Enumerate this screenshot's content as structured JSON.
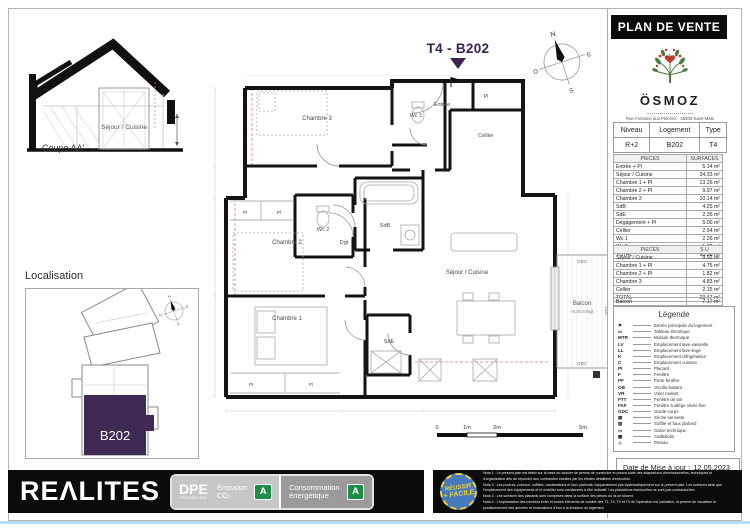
{
  "header": {
    "title": "PLAN DE VENTE"
  },
  "brand": {
    "name": "ÖSMOZ",
    "address": "Rue Fontaine aux Pèlerins - 35400 Saint-Malo"
  },
  "unit_banner": {
    "title": "T4 - B202"
  },
  "info_table": {
    "headers": [
      "Niveau",
      "Logement",
      "Type"
    ],
    "row": [
      "R+2",
      "B202",
      "T4"
    ]
  },
  "surfaces_table": {
    "headers": [
      "PIECES",
      "SURFACES"
    ],
    "rows": [
      [
        "Entrée + Pl",
        "5.14 m²"
      ],
      [
        "Séjour / Cuisine",
        "34.33 m²"
      ],
      [
        "Chambre 1 + Pl",
        "13.26 m²"
      ],
      [
        "Chambre 2 + Pl",
        "9.97 m²"
      ],
      [
        "Chambre 3",
        "10.14 m²"
      ],
      [
        "SdB",
        "4.25 m²"
      ],
      [
        "SdE",
        "2.35 m²"
      ],
      [
        "Dégagement + Pl",
        "5.00 m²"
      ],
      [
        "Cellier",
        "2.54 m²"
      ],
      [
        "Wc 1",
        "2.26 m²"
      ],
      [
        "Wc 2",
        "1.32 m²"
      ]
    ],
    "total_label": "TOTAL",
    "total_value": "90.56 m²"
  },
  "su_table": {
    "headers": [
      "PIECES",
      "S.U"
    ],
    "rows": [
      [
        "Séjour / Cuisine",
        "9.92 m²"
      ],
      [
        "Chambre 1 + Pl",
        "4.75 m²"
      ],
      [
        "Chambre 2 + Pl",
        "1.82 m²"
      ],
      [
        "Chambre 3",
        "4.83 m²"
      ],
      [
        "Cellier",
        "2.15 m²"
      ]
    ],
    "total_label": "TOTAL",
    "total_value": "23.47 m²",
    "balcon_label": "Balcon",
    "balcon_value": "7.17 m²"
  },
  "legend": {
    "title": "Légende",
    "items": [
      {
        "symbol": "⚑",
        "label": "Entrée principale du logement"
      },
      {
        "symbol": "▭",
        "label": "Tableau électrique"
      },
      {
        "symbol": "MTR",
        "label": "Module thermique"
      },
      {
        "symbol": "LV",
        "label": "Emplacement lave-vaisselle"
      },
      {
        "symbol": "LL",
        "label": "Emplacement lave-linge"
      },
      {
        "symbol": "K",
        "label": "Emplacement réfrigérateur"
      },
      {
        "symbol": "C",
        "label": "Emplacement cuisson"
      },
      {
        "symbol": "Pl",
        "label": "Placard"
      },
      {
        "symbol": "F",
        "label": "Fenêtre"
      },
      {
        "symbol": "PF",
        "label": "Porte fenêtre"
      },
      {
        "symbol": "OB",
        "label": "Oscillo-battant"
      },
      {
        "symbol": "VR",
        "label": "Volet roulant"
      },
      {
        "symbol": "FTT",
        "label": "Fenêtre de toit"
      },
      {
        "symbol": "FAF",
        "label": "Fenêtre à allège vitrée fixe"
      },
      {
        "symbol": "GDC",
        "label": "Garde-corps"
      },
      {
        "symbol": "▤",
        "label": "Sèche serviette"
      },
      {
        "symbol": "▨",
        "label": "Soffite et faux plafond"
      },
      {
        "symbol": "▭",
        "label": "Gaine technique"
      },
      {
        "symbol": "▦",
        "label": "Caillebotis"
      },
      {
        "symbol": "⊥",
        "label": "Poteau"
      }
    ]
  },
  "date_update": {
    "label": "Date de Mise à jour :",
    "value": "12.05.2023"
  },
  "coupe": {
    "caption": "Coupe AA'",
    "room_label": "Séjour / Cuisine"
  },
  "localisation": {
    "title": "Localisation",
    "unit": "B202"
  },
  "plan": {
    "rooms": {
      "chambre3": "Chambre 3",
      "wc1": "Wc 1",
      "entree": "Entrée",
      "cellier": "Cellier",
      "pl": "Pl",
      "wc2": "Wc 2",
      "sdb": "SdB",
      "dgt": "Dgt",
      "chambre2": "Chambre 2",
      "chambre1": "Chambre 1",
      "sde": "SdE",
      "sejour": "Séjour / Cuisine",
      "balcon": "Balcon"
    },
    "balcon_note": "+0.05 m/logt",
    "gdc": "GDC"
  },
  "scale_bar": {
    "labels": [
      "0",
      "1m",
      "2m",
      "5m"
    ]
  },
  "compass": {
    "n": "N",
    "e": "E",
    "s": "S",
    "o": "O"
  },
  "footer": {
    "logo": "REΛLITES",
    "dpe": {
      "title": "DPE",
      "subtitle": "PROVISOIRE",
      "emission_l1": "Émission",
      "emission_l2": "CO₂",
      "emission_grade": "A",
      "conso_l1": "Consommation",
      "conso_l2": "énergétique",
      "conso_grade": "A"
    },
    "badge": {
      "line1": "RÉUSSIR",
      "line2": "+ FACILE"
    },
    "notes": [
      "Nota 1 : Le présent plan est établi sur la base du dossier de permis de construire et pourra subir des adaptations dimensionnelles, techniques et d'organisation afin de répondre aux contraintes induites par les études détaillées d'exécution.",
      "Nota 2 : Les poutres, poteaux, soffites, canalisations et faux plafonds n'apparaissent pas systématiquement sur le présent plan. Les surfaces ainsi que l'emplacement des équipements et le mobilier sont mentionnés à titre indicatif. Les plantations éventuelles ne sont pas contractuelles.",
      "Nota 3 : Les surfaces des placards sont comprises dans la surface des pièces où ils se situent.",
      "Nota 4 : L'implantation des meubles évier et autres éléments de cuisine des T1, T2, T4 et T5 de l'opération est indicative, et permet de visualiser le positionnement des arrivées et évacuations d'eau à la livraison du logement."
    ]
  }
}
